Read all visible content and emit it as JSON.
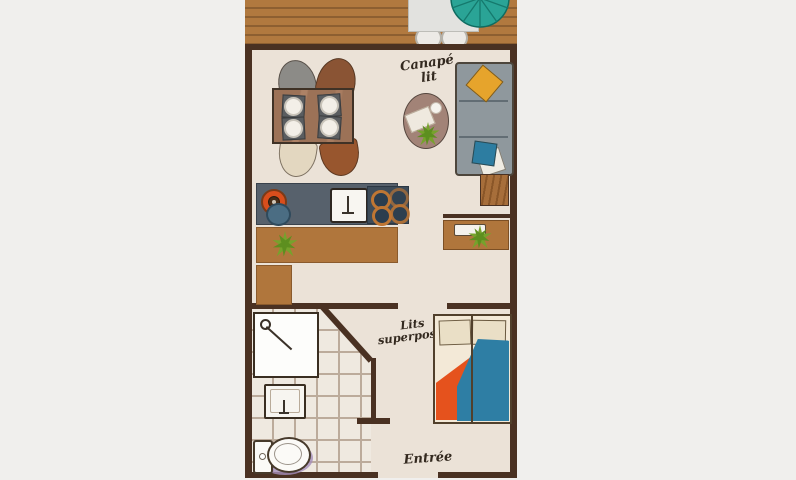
{
  "labels": {
    "sofa_bed": {
      "line1": "Canapé",
      "line2": "lit"
    },
    "bunk_beds": {
      "line1": "Lits",
      "line2": "superposés"
    },
    "entrance": "Entrée"
  },
  "colors": {
    "background": "#f0efed",
    "floor": "#ebe2d7",
    "wall": "#4a3122",
    "deck_wood": "#b1793f",
    "deck_stripe": "#8d5f31",
    "furniture_wood": "#b0763c",
    "table_wood": "#9c7257",
    "counter": "#57616c",
    "stove": "#3e4c59",
    "burner_ring": "#bf7633",
    "sink_blue": "#4b6d83",
    "knob_red": "#d94e1c",
    "sofa": "#8f989d",
    "pillow_yellow": "#e6a42c",
    "pillow_blue": "#2d7da1",
    "pillow_beige": "#eadfc6",
    "blanket_orange": "#e5521d",
    "blanket_blue": "#2e7ea4",
    "bed_frame": "#f3e9d7",
    "parasol": "#2aa496",
    "plant": "#76a22c",
    "tile_line": "#bcab9b",
    "toilet_shadow": "#a58fbc",
    "coffee_table": "#a28377",
    "chair_gray": "#8c8b87",
    "chair_brown": "#8a5434",
    "chair_cream": "#e3d7c0",
    "chair_rust": "#98562e",
    "label_ink": "#33291f"
  }
}
